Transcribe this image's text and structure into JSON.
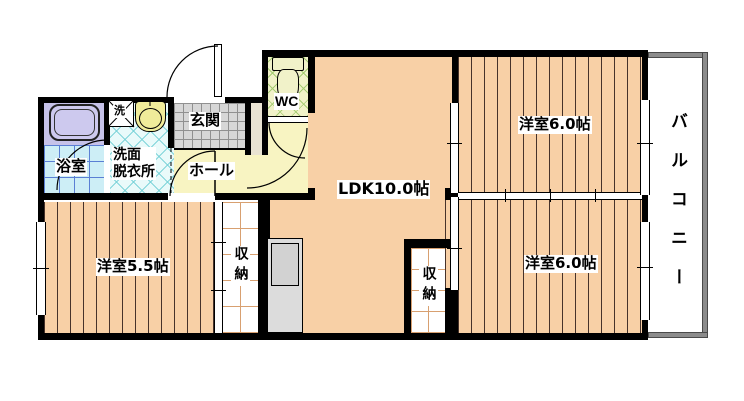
{
  "plan": {
    "rooms": {
      "bath": "浴室",
      "washer": "洗",
      "washroom": "洗面\n脱衣所",
      "entrance": "玄関",
      "wc": "WC",
      "hall": "ホール",
      "ldk": "LDK10.0帖",
      "bedroom_top": "洋室6.0帖",
      "bedroom_bottom": "洋室6.0帖",
      "bedroom_left": "洋室5.5帖",
      "closet_left": "収納",
      "closet_right": "収納",
      "balcony": "バルコニー"
    }
  },
  "colors": {
    "wall": "#000000",
    "wood_floor": "#f8d0a6",
    "wood_stripe": "#46322a",
    "hall_floor": "#f8f4c2",
    "wc_floor": "#f1f2c9",
    "wc_lattice": "#a6cc74",
    "washroom_floor": "#e9fafa",
    "washroom_lattice": "#7fd4da",
    "bath_floor": "#cdeef6",
    "bath_grid": "#5b7fd4",
    "bathtub_zone": "#c6c2e9",
    "bathtub_fill": "#cdc9ee",
    "entrance_tile": "#d7d7d7",
    "entrance_grid": "#909090",
    "entrance_step": "#e9e3d2",
    "closet_grid": "#d8a070",
    "balcony_wall": "#8c8c8c",
    "fixture_yellow": "#f0ec9a",
    "kitchen_gray": "#dcdcdc"
  }
}
